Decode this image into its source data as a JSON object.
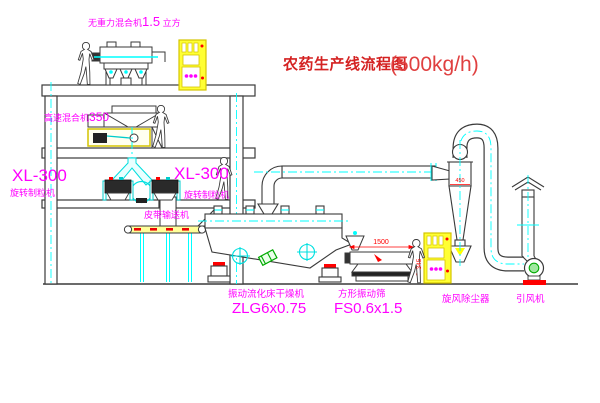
{
  "title": {
    "name": "农药生产线流程图",
    "capacity": "(500kg/h)"
  },
  "equipment": {
    "gravity_mixer": {
      "name": "无重力混合机",
      "size": "1.5",
      "unit": " 立方"
    },
    "high_speed_mixer": {
      "name": "高速混合机",
      "model": "350"
    },
    "granulator_left": {
      "model": "XL-300",
      "name": "旋转制粒机"
    },
    "granulator_right": {
      "model": "XL-300",
      "name": "旋转制粒机"
    },
    "belt_conveyor": {
      "name": "皮带输送机"
    },
    "fluid_bed_dryer": {
      "name": "振动流化床干燥机",
      "model": "ZLG6x0.75"
    },
    "vibrating_sieve": {
      "name": "方形振动筛",
      "model": "FS0.6x1.5"
    },
    "cyclone": {
      "name": "旋风除尘器"
    },
    "draft_fan": {
      "name": "引风机"
    }
  },
  "dimensions": {
    "sieve_length": "1500",
    "sieve_height": "345",
    "cyclone_inlet": "450"
  },
  "colors": {
    "label": "#ff00ff",
    "title": "#d42222",
    "line": "#3a3a3a",
    "centerline": "#00ffff",
    "highlight": "#ffff00",
    "accent_red": "#ff0000",
    "accent_green": "#00aa00"
  }
}
